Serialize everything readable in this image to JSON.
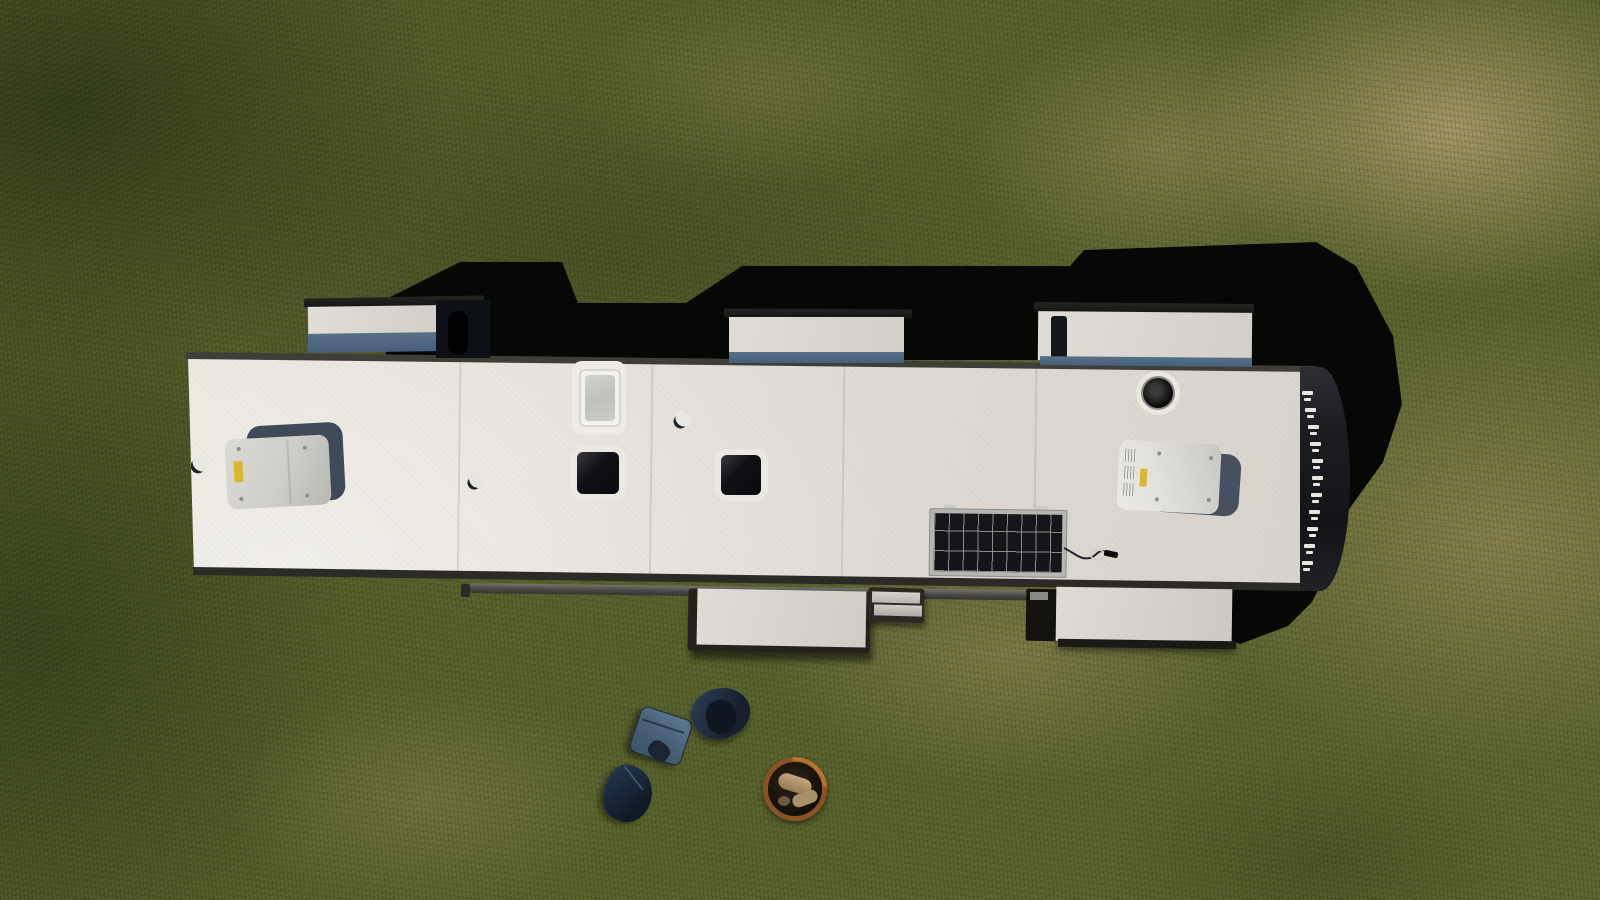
{
  "scene": {
    "type": "aerial-drone-photograph",
    "subject": "Top-down view of a long white travel-trailer RV roof parked on patchy green-and-tan grass, with slide-outs extended, rooftop equipment, and camping items on the lawn",
    "objects": [
      {
        "id": "grass-field",
        "label": "patchy grass field with dry tan spots"
      },
      {
        "id": "rv-shadow",
        "label": "hard black shadow cast by the RV and slide-outs"
      },
      {
        "id": "rv-roof",
        "label": "white RV rubber roof"
      },
      {
        "id": "roof-top-trim",
        "label": "dark trim rail along upper roof edge"
      },
      {
        "id": "roof-bottom-trim",
        "label": "dark trim rail along lower roof edge"
      },
      {
        "id": "awning-roller",
        "label": "retracted awning roller tube"
      },
      {
        "id": "slide-out-top-left",
        "label": "extended slide-out, curb side left"
      },
      {
        "id": "slide-out-top-middle",
        "label": "extended slide-out, curb side middle"
      },
      {
        "id": "slide-out-top-right",
        "label": "extended slide-out, curb side right"
      },
      {
        "id": "slide-out-bottom-middle",
        "label": "extended slide-out, door side middle"
      },
      {
        "id": "slide-out-bottom-right",
        "label": "extended slide-out, door side right"
      },
      {
        "id": "entry-steps",
        "label": "fold-out entry steps"
      },
      {
        "id": "rear-cap-ladder",
        "label": "dark rounded rear cap with white ladder rungs"
      },
      {
        "id": "ac-unit-front",
        "label": "rooftop air-conditioner shroud, front"
      },
      {
        "id": "ac-unit-rear",
        "label": "rooftop air-conditioner shroud, rear"
      },
      {
        "id": "skylight",
        "label": "frosted skylight with sealant ring"
      },
      {
        "id": "roof-vent-left",
        "label": "dark roof vent lid, left"
      },
      {
        "id": "roof-vent-right",
        "label": "dark roof vent lid, right"
      },
      {
        "id": "refrigerator-vent-hole",
        "label": "round black refrigerator vent opening"
      },
      {
        "id": "plumbing-vent-1",
        "label": "small plumbing vent cap"
      },
      {
        "id": "plumbing-vent-2",
        "label": "small plumbing vent cap"
      },
      {
        "id": "plumbing-vent-3",
        "label": "small plumbing vent cap"
      },
      {
        "id": "solar-panel",
        "label": "portable solar panel lying on roof"
      },
      {
        "id": "solar-cable",
        "label": "solar panel cable with connector"
      },
      {
        "id": "cooler",
        "label": "blue cooler on the grass"
      },
      {
        "id": "tarp-pile",
        "label": "dark blue tarp or canopy bag"
      },
      {
        "id": "duffel-bag",
        "label": "dark blue duffel bag"
      },
      {
        "id": "fire-pit-ring",
        "label": "steel fire ring with firewood"
      }
    ]
  },
  "palette": {
    "grass_green": "#57612b",
    "grass_dark": "#3c4418",
    "dirt_tan": "#a4946a",
    "shadow_black": "#060805",
    "roof_white": "#e4e0d8",
    "slide_out_blue": "#4e6a80",
    "trim_dark": "#2c2a24",
    "sticker_yellow": "#d9b733",
    "solar_cell_dark": "#16161a",
    "cooler_blue": "#48637a",
    "tarp_navy": "#1c2a3c",
    "fire_ring_rust": "#8e5526",
    "ladder_white": "#f2f0ea"
  }
}
